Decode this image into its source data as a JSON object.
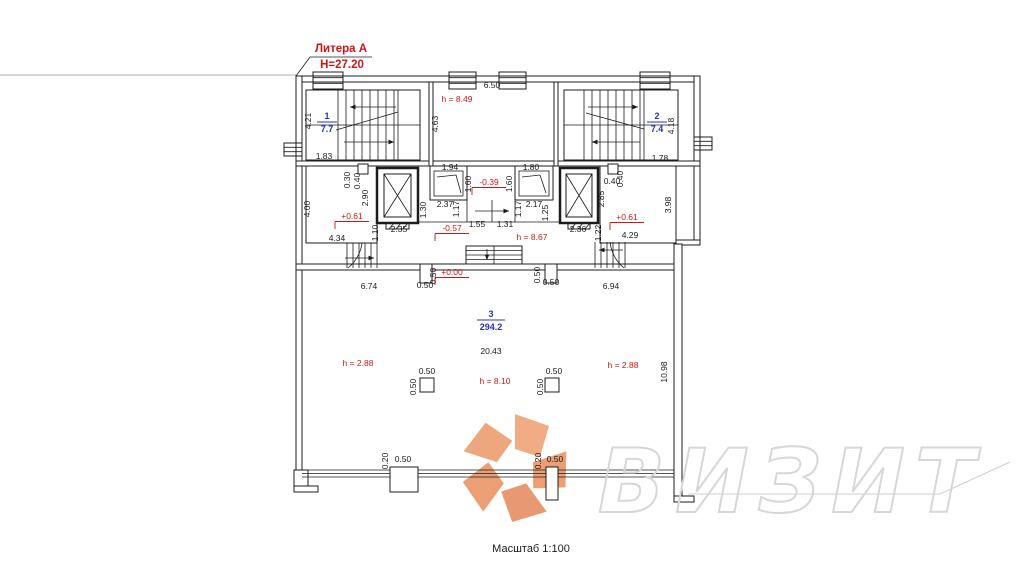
{
  "header": {
    "litera": "Литера А",
    "building_height": "Н=27.20"
  },
  "footer": {
    "scale_label": "Масштаб 1:100"
  },
  "watermark": {
    "text": "ВИЗИТ"
  },
  "colors": {
    "line": "#1c1c1c",
    "annotation_red": "#cc1714",
    "room_blue": "#2733b4",
    "watermark_gray": "#d7d7d7",
    "logo_orange": "#eb9a6e"
  },
  "plan": {
    "rooms": [
      {
        "number": "1",
        "area": "7.7",
        "x": 327,
        "y": 122,
        "w": 10
      },
      {
        "number": "2",
        "area": "7.4",
        "x": 657,
        "y": 122,
        "w": 10
      },
      {
        "number": "3",
        "area": "294.2",
        "x": 491,
        "y": 320,
        "w": 14
      }
    ],
    "labels": [
      {
        "text": "4.21",
        "x": 311,
        "y": 121,
        "rot": -90
      },
      {
        "text": "1.83",
        "x": 324,
        "y": 159
      },
      {
        "text": "h = 8.49",
        "x": 457,
        "y": 102,
        "kind": "height"
      },
      {
        "text": "4.63",
        "x": 438,
        "y": 124,
        "rot": -90
      },
      {
        "text": "6.50",
        "x": 492,
        "y": 88
      },
      {
        "text": "1.94",
        "x": 450,
        "y": 170
      },
      {
        "text": "1.80",
        "x": 531,
        "y": 170
      },
      {
        "text": "4.18",
        "x": 674,
        "y": 126,
        "rot": -90
      },
      {
        "text": "1.78",
        "x": 660,
        "y": 161
      },
      {
        "text": "0.30",
        "x": 350,
        "y": 180,
        "rot": -90
      },
      {
        "text": "0.40",
        "x": 360,
        "y": 181,
        "rot": -90
      },
      {
        "text": "2.90",
        "x": 368,
        "y": 198,
        "rot": -90
      },
      {
        "text": "4.00",
        "x": 310,
        "y": 209,
        "rot": -90
      },
      {
        "text": "+0.61",
        "x": 352,
        "y": 219,
        "kind": "elev"
      },
      {
        "text": "1.10",
        "x": 378,
        "y": 233,
        "rot": -90
      },
      {
        "text": "4.34",
        "x": 337,
        "y": 241
      },
      {
        "text": "2.35",
        "x": 399,
        "y": 232
      },
      {
        "text": "1.30",
        "x": 426,
        "y": 210,
        "rot": -90
      },
      {
        "text": "2.37",
        "x": 445,
        "y": 207
      },
      {
        "text": "1.17",
        "x": 459,
        "y": 209,
        "rot": -90
      },
      {
        "text": "1.60",
        "x": 471,
        "y": 184,
        "rot": -90
      },
      {
        "text": "-0.39",
        "x": 489,
        "y": 185,
        "kind": "elev"
      },
      {
        "text": "1.60",
        "x": 512,
        "y": 184,
        "rot": -90
      },
      {
        "text": "2.17",
        "x": 534,
        "y": 207
      },
      {
        "text": "1.17",
        "x": 521,
        "y": 209,
        "rot": -90
      },
      {
        "text": "1.25",
        "x": 548,
        "y": 213,
        "rot": -90
      },
      {
        "text": "1.55",
        "x": 477,
        "y": 227
      },
      {
        "text": "1.31",
        "x": 505,
        "y": 227
      },
      {
        "text": "-0.57",
        "x": 452,
        "y": 231,
        "kind": "elev"
      },
      {
        "text": "h = 8.67",
        "x": 532,
        "y": 240,
        "kind": "height"
      },
      {
        "text": "2.36",
        "x": 578,
        "y": 232
      },
      {
        "text": "0.40",
        "x": 612,
        "y": 184
      },
      {
        "text": "0.40",
        "x": 623,
        "y": 179,
        "rot": -90
      },
      {
        "text": "2.85",
        "x": 604,
        "y": 199,
        "rot": -90
      },
      {
        "text": "+0.61",
        "x": 627,
        "y": 220,
        "kind": "elev"
      },
      {
        "text": "1.22",
        "x": 601,
        "y": 233,
        "rot": -90
      },
      {
        "text": "4.29",
        "x": 630,
        "y": 238
      },
      {
        "text": "3.98",
        "x": 671,
        "y": 205,
        "rot": -90
      },
      {
        "text": "0.50",
        "x": 436,
        "y": 276,
        "rot": -90
      },
      {
        "text": "0.50",
        "x": 425,
        "y": 288
      },
      {
        "text": "+0.00",
        "x": 452,
        "y": 275,
        "kind": "elev"
      },
      {
        "text": "6.74",
        "x": 369,
        "y": 289
      },
      {
        "text": "0.50",
        "x": 540,
        "y": 275,
        "rot": -90
      },
      {
        "text": "0.50",
        "x": 551,
        "y": 285
      },
      {
        "text": "6.94",
        "x": 611,
        "y": 289
      },
      {
        "text": "20.43",
        "x": 491,
        "y": 354
      },
      {
        "text": "h = 2.88",
        "x": 358,
        "y": 366,
        "kind": "height"
      },
      {
        "text": "0.50",
        "x": 427,
        "y": 374
      },
      {
        "text": "0.50",
        "x": 416,
        "y": 387,
        "rot": -90
      },
      {
        "text": "h = 8.10",
        "x": 495,
        "y": 384,
        "kind": "height"
      },
      {
        "text": "0.50",
        "x": 554,
        "y": 374
      },
      {
        "text": "0.50",
        "x": 543,
        "y": 387,
        "rot": -90
      },
      {
        "text": "h = 2.88",
        "x": 623,
        "y": 368,
        "kind": "height"
      },
      {
        "text": "10.98",
        "x": 667,
        "y": 372,
        "rot": -90
      },
      {
        "text": "0.20",
        "x": 388,
        "y": 461,
        "rot": -90
      },
      {
        "text": "0.50",
        "x": 403,
        "y": 462
      },
      {
        "text": "0.20",
        "x": 541,
        "y": 461,
        "rot": -90
      },
      {
        "text": "0.50",
        "x": 555,
        "y": 462
      }
    ]
  }
}
